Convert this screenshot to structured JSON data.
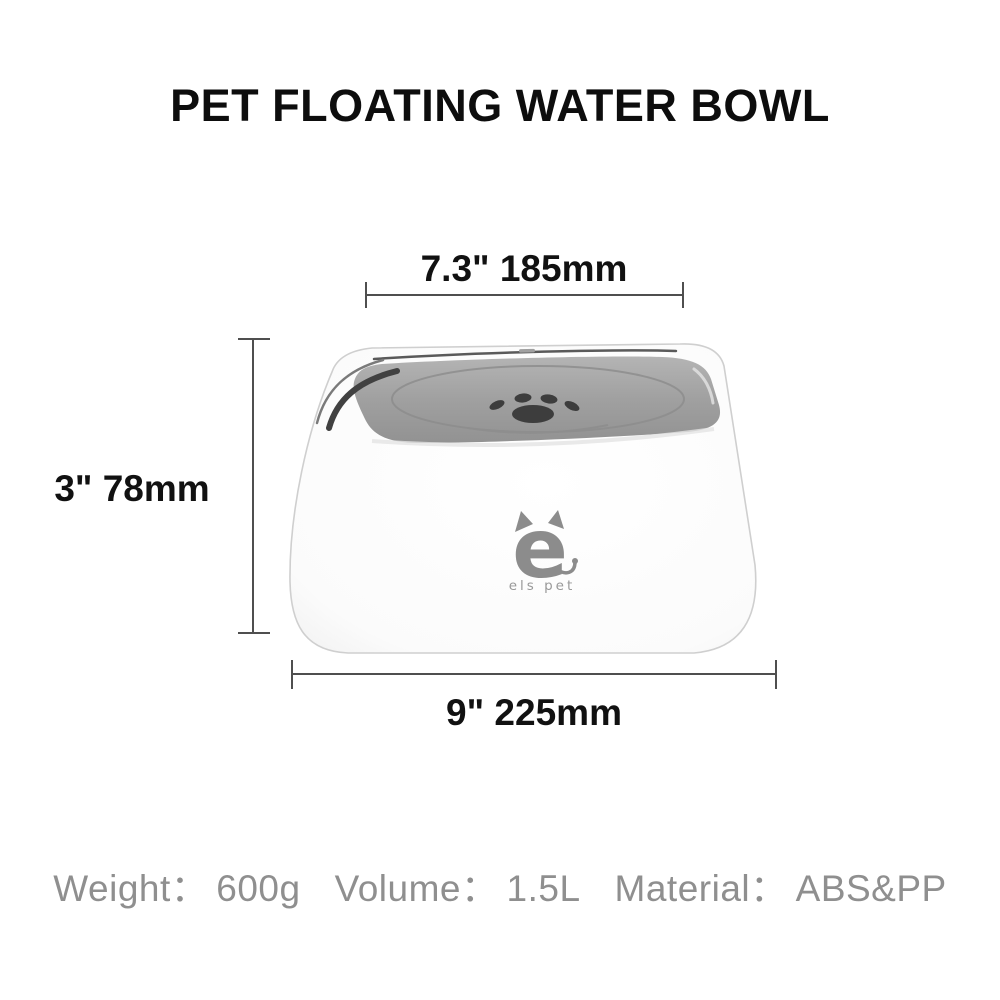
{
  "title": "PET FLOATING WATER BOWL",
  "dimensions": {
    "width_top": "7.3\" 185mm",
    "height": "3\" 78mm",
    "width_bottom": "9\" 225mm"
  },
  "product": {
    "brand_mark": "e",
    "brand_name": "els pet"
  },
  "specs": {
    "items": [
      {
        "label": "Weight：",
        "value": "600g"
      },
      {
        "label": "Volume：",
        "value": "1.5L"
      },
      {
        "label": "Material：",
        "value": "ABS&PP"
      }
    ]
  },
  "colors": {
    "plate_gray_light": "#b6b6b6",
    "plate_gray_dark": "#8f8f8f",
    "rim_shadow": "#414141",
    "paw_dark": "#3d3d3d",
    "logo_gray": "#8c8c8c",
    "dimension_line": "#4f4f4f",
    "spec_text": "#8f8f8f",
    "body_white": "#ffffff"
  }
}
